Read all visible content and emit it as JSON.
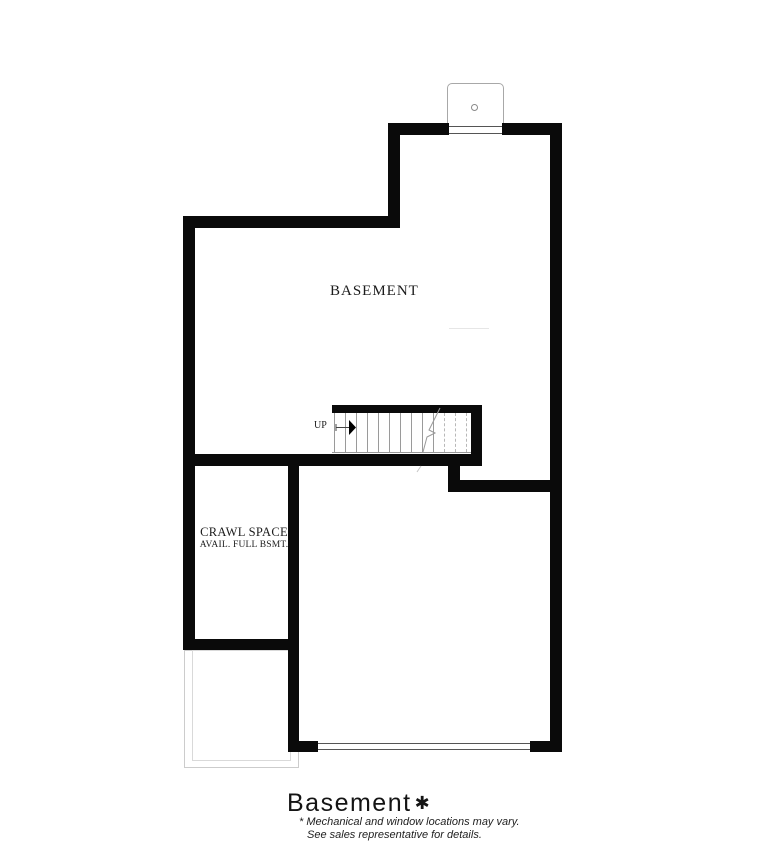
{
  "plan": {
    "rooms": {
      "basement_label": "BASEMENT",
      "crawl_space_label": "CRAWL SPACE",
      "crawl_space_sublabel": "AVAIL. FULL BSMT.",
      "stairs_direction_label": "UP"
    },
    "title": {
      "text": "Basement",
      "asterisk": "✱"
    },
    "footnotes": [
      "* Mechanical and window locations may vary.",
      "See sales representative for details."
    ],
    "colors": {
      "wall": "#0a0a0a",
      "stair_line": "#999999",
      "window_line": "#555555",
      "porch_outline": "#cccccc",
      "background": "#ffffff"
    }
  }
}
